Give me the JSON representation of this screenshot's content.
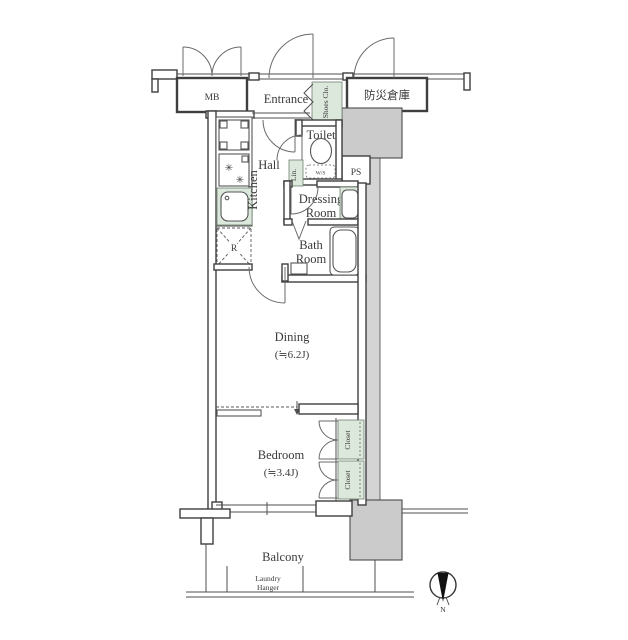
{
  "meta": {
    "type": "apartment-floor-plan"
  },
  "colors": {
    "storage_green": "#dce8db",
    "structure_gray": "#cbcbcb",
    "wall_line": "#3f3f3f",
    "background": "#ffffff"
  },
  "labels": {
    "mb": "MB",
    "entrance": "Entrance",
    "shoes_closet": "Shoes Clo.",
    "disaster_storage": "防災倉庫",
    "toilet": "Toilet",
    "washlet": "W/S",
    "ps": "PS",
    "hall": "Hall",
    "kitchen": "Kitchen",
    "linen": "Lin.",
    "refrigerator": "R",
    "dressing_line1": "Dressing",
    "dressing_line2": "Room",
    "bath_line1": "Bath",
    "bath_line2": "Room",
    "dining": "Dining",
    "dining_size": "(≒6.2J)",
    "bedroom": "Bedroom",
    "bedroom_size": "(≒3.4J)",
    "closet_upper": "Closet",
    "closet_lower": "Closet",
    "balcony": "Balcony",
    "laundry_line1": "Laundry",
    "laundry_line2": "Hanger",
    "north": "N"
  },
  "icons": {
    "burner": "✳"
  }
}
